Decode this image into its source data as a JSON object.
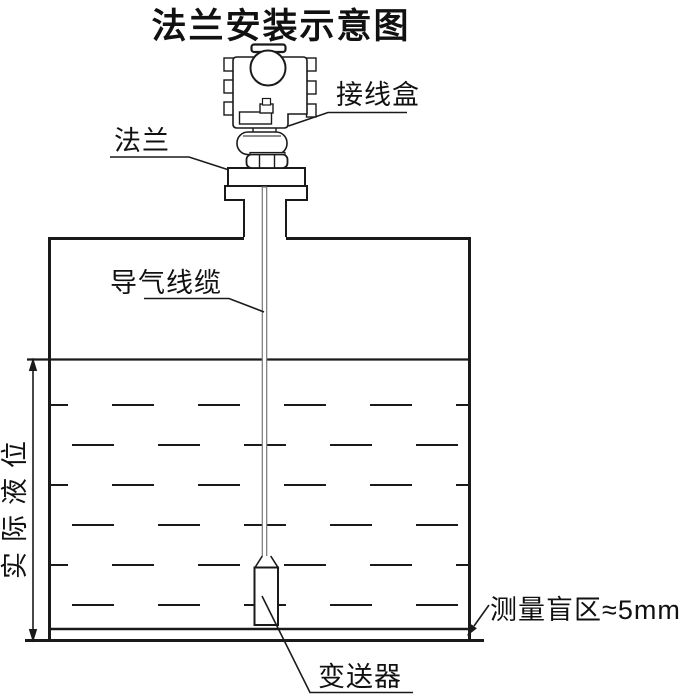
{
  "title": "法兰安装示意图",
  "labels": {
    "junction_box": "接线盒",
    "flange": "法兰",
    "air_cable": "导气线缆",
    "actual_level": "实际液位",
    "transmitter": "变送器",
    "blind_zone": "测量盲区≈5mm"
  },
  "colors": {
    "line": "#1a1a1a",
    "cable": "#777777",
    "background": "#ffffff"
  }
}
